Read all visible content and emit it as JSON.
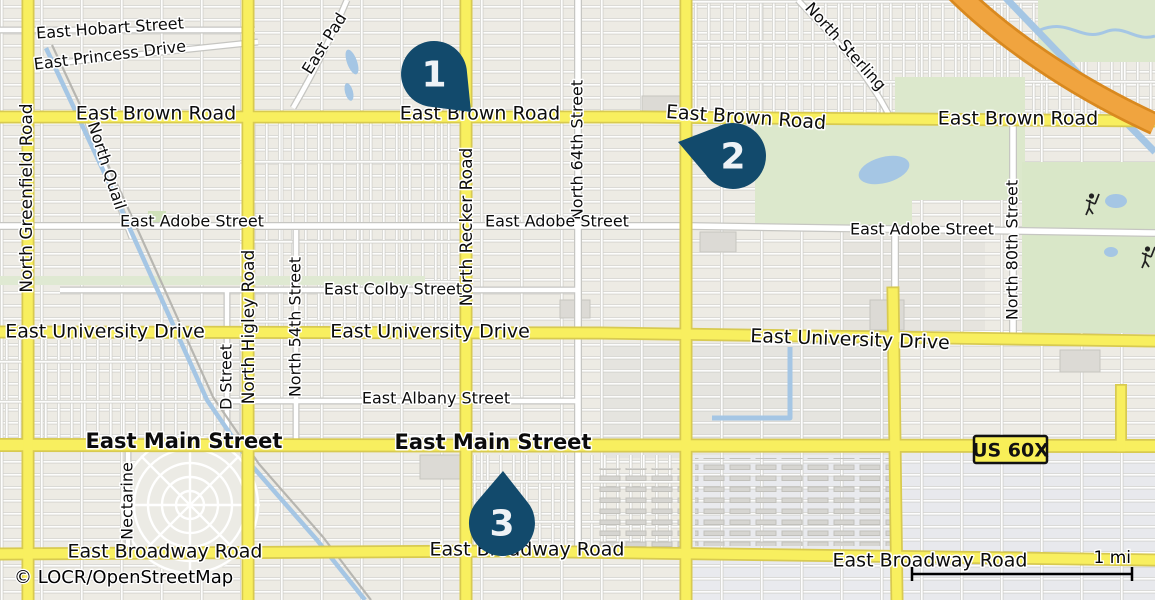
{
  "map": {
    "attribution": "© LOCR/OpenStreetMap",
    "scale": {
      "label": "1 mi"
    },
    "route_badge": {
      "label": "US 60X"
    },
    "colors": {
      "marker": "#124a6c",
      "marker_text": "#eef2f6",
      "road_yellow": "#f8ef5f",
      "road_yellow_casing": "#d8ca50",
      "highway_orange": "#f0a43f",
      "highway_casing": "#d9891f",
      "water": "#a5c6e4",
      "park": "#dce8cc",
      "background": "#edebe4"
    },
    "markers": [
      {
        "label": "1",
        "cx": 434,
        "cy": 74,
        "tx": 471,
        "ty": 112
      },
      {
        "label": "2",
        "cx": 733,
        "cy": 156,
        "tx": 678,
        "ty": 142
      },
      {
        "label": "3",
        "cx": 502,
        "cy": 523,
        "tx": 503,
        "ty": 471
      }
    ],
    "labels": [
      {
        "t": "East Hobart Street",
        "x": 110,
        "y": 29,
        "r": -4,
        "s": 16
      },
      {
        "t": "East Princess Drive",
        "x": 110,
        "y": 56,
        "r": -7,
        "s": 16
      },
      {
        "t": "East Pad",
        "x": 325,
        "y": 44,
        "r": -58,
        "s": 16
      },
      {
        "t": "North Quail",
        "x": 106,
        "y": 166,
        "r": 72,
        "s": 16
      },
      {
        "t": "North Sterling",
        "x": 845,
        "y": 47,
        "r": 48,
        "s": 16
      },
      {
        "t": "North Greenfield Road",
        "x": 27,
        "y": 198,
        "r": -90,
        "s": 17
      },
      {
        "t": "North Higley Road",
        "x": 249,
        "y": 327,
        "r": -90,
        "s": 17
      },
      {
        "t": "North Recker Road",
        "x": 467,
        "y": 227,
        "r": -90,
        "s": 17
      },
      {
        "t": "North 64th Street",
        "x": 578,
        "y": 150,
        "r": -90,
        "s": 16
      },
      {
        "t": "North 54th Street",
        "x": 296,
        "y": 327,
        "r": -90,
        "s": 16
      },
      {
        "t": "D Street",
        "x": 227,
        "y": 377,
        "r": -90,
        "s": 16
      },
      {
        "t": "Nectarine",
        "x": 128,
        "y": 501,
        "r": -90,
        "s": 16
      },
      {
        "t": "North 80th Street",
        "x": 1013,
        "y": 250,
        "r": -90,
        "s": 16
      },
      {
        "t": "East Brown Road",
        "x": 156,
        "y": 114,
        "r": 0,
        "s": 19
      },
      {
        "t": "East Brown Road",
        "x": 480,
        "y": 114,
        "r": 0,
        "s": 19
      },
      {
        "t": "East Brown Road",
        "x": 746,
        "y": 118,
        "r": 4,
        "s": 19
      },
      {
        "t": "East Brown Road",
        "x": 1018,
        "y": 119,
        "r": 0,
        "s": 19
      },
      {
        "t": "East Adobe Street",
        "x": 192,
        "y": 222,
        "r": 0,
        "s": 16
      },
      {
        "t": "East Adobe Street",
        "x": 557,
        "y": 222,
        "r": 0,
        "s": 16
      },
      {
        "t": "East Adobe Street",
        "x": 922,
        "y": 230,
        "r": 0,
        "s": 16
      },
      {
        "t": "East Colby Street",
        "x": 393,
        "y": 290,
        "r": 0,
        "s": 16
      },
      {
        "t": "East University Drive",
        "x": 105,
        "y": 332,
        "r": 0,
        "s": 19
      },
      {
        "t": "East University Drive",
        "x": 430,
        "y": 332,
        "r": 0,
        "s": 19
      },
      {
        "t": "East University Drive",
        "x": 850,
        "y": 340,
        "r": 2,
        "s": 19
      },
      {
        "t": "East Albany Street",
        "x": 436,
        "y": 399,
        "r": 0,
        "s": 16
      },
      {
        "t": "East Main Street",
        "x": 184,
        "y": 442,
        "r": 0,
        "s": 21,
        "b": 1
      },
      {
        "t": "East Main Street",
        "x": 493,
        "y": 443,
        "r": 0,
        "s": 21,
        "b": 1
      },
      {
        "t": "East Broadway Road",
        "x": 165,
        "y": 552,
        "r": 0,
        "s": 19
      },
      {
        "t": "East Broadway Road",
        "x": 527,
        "y": 550,
        "r": 0,
        "s": 19
      },
      {
        "t": "East Broadway Road",
        "x": 930,
        "y": 561,
        "r": 0,
        "s": 19
      }
    ]
  }
}
